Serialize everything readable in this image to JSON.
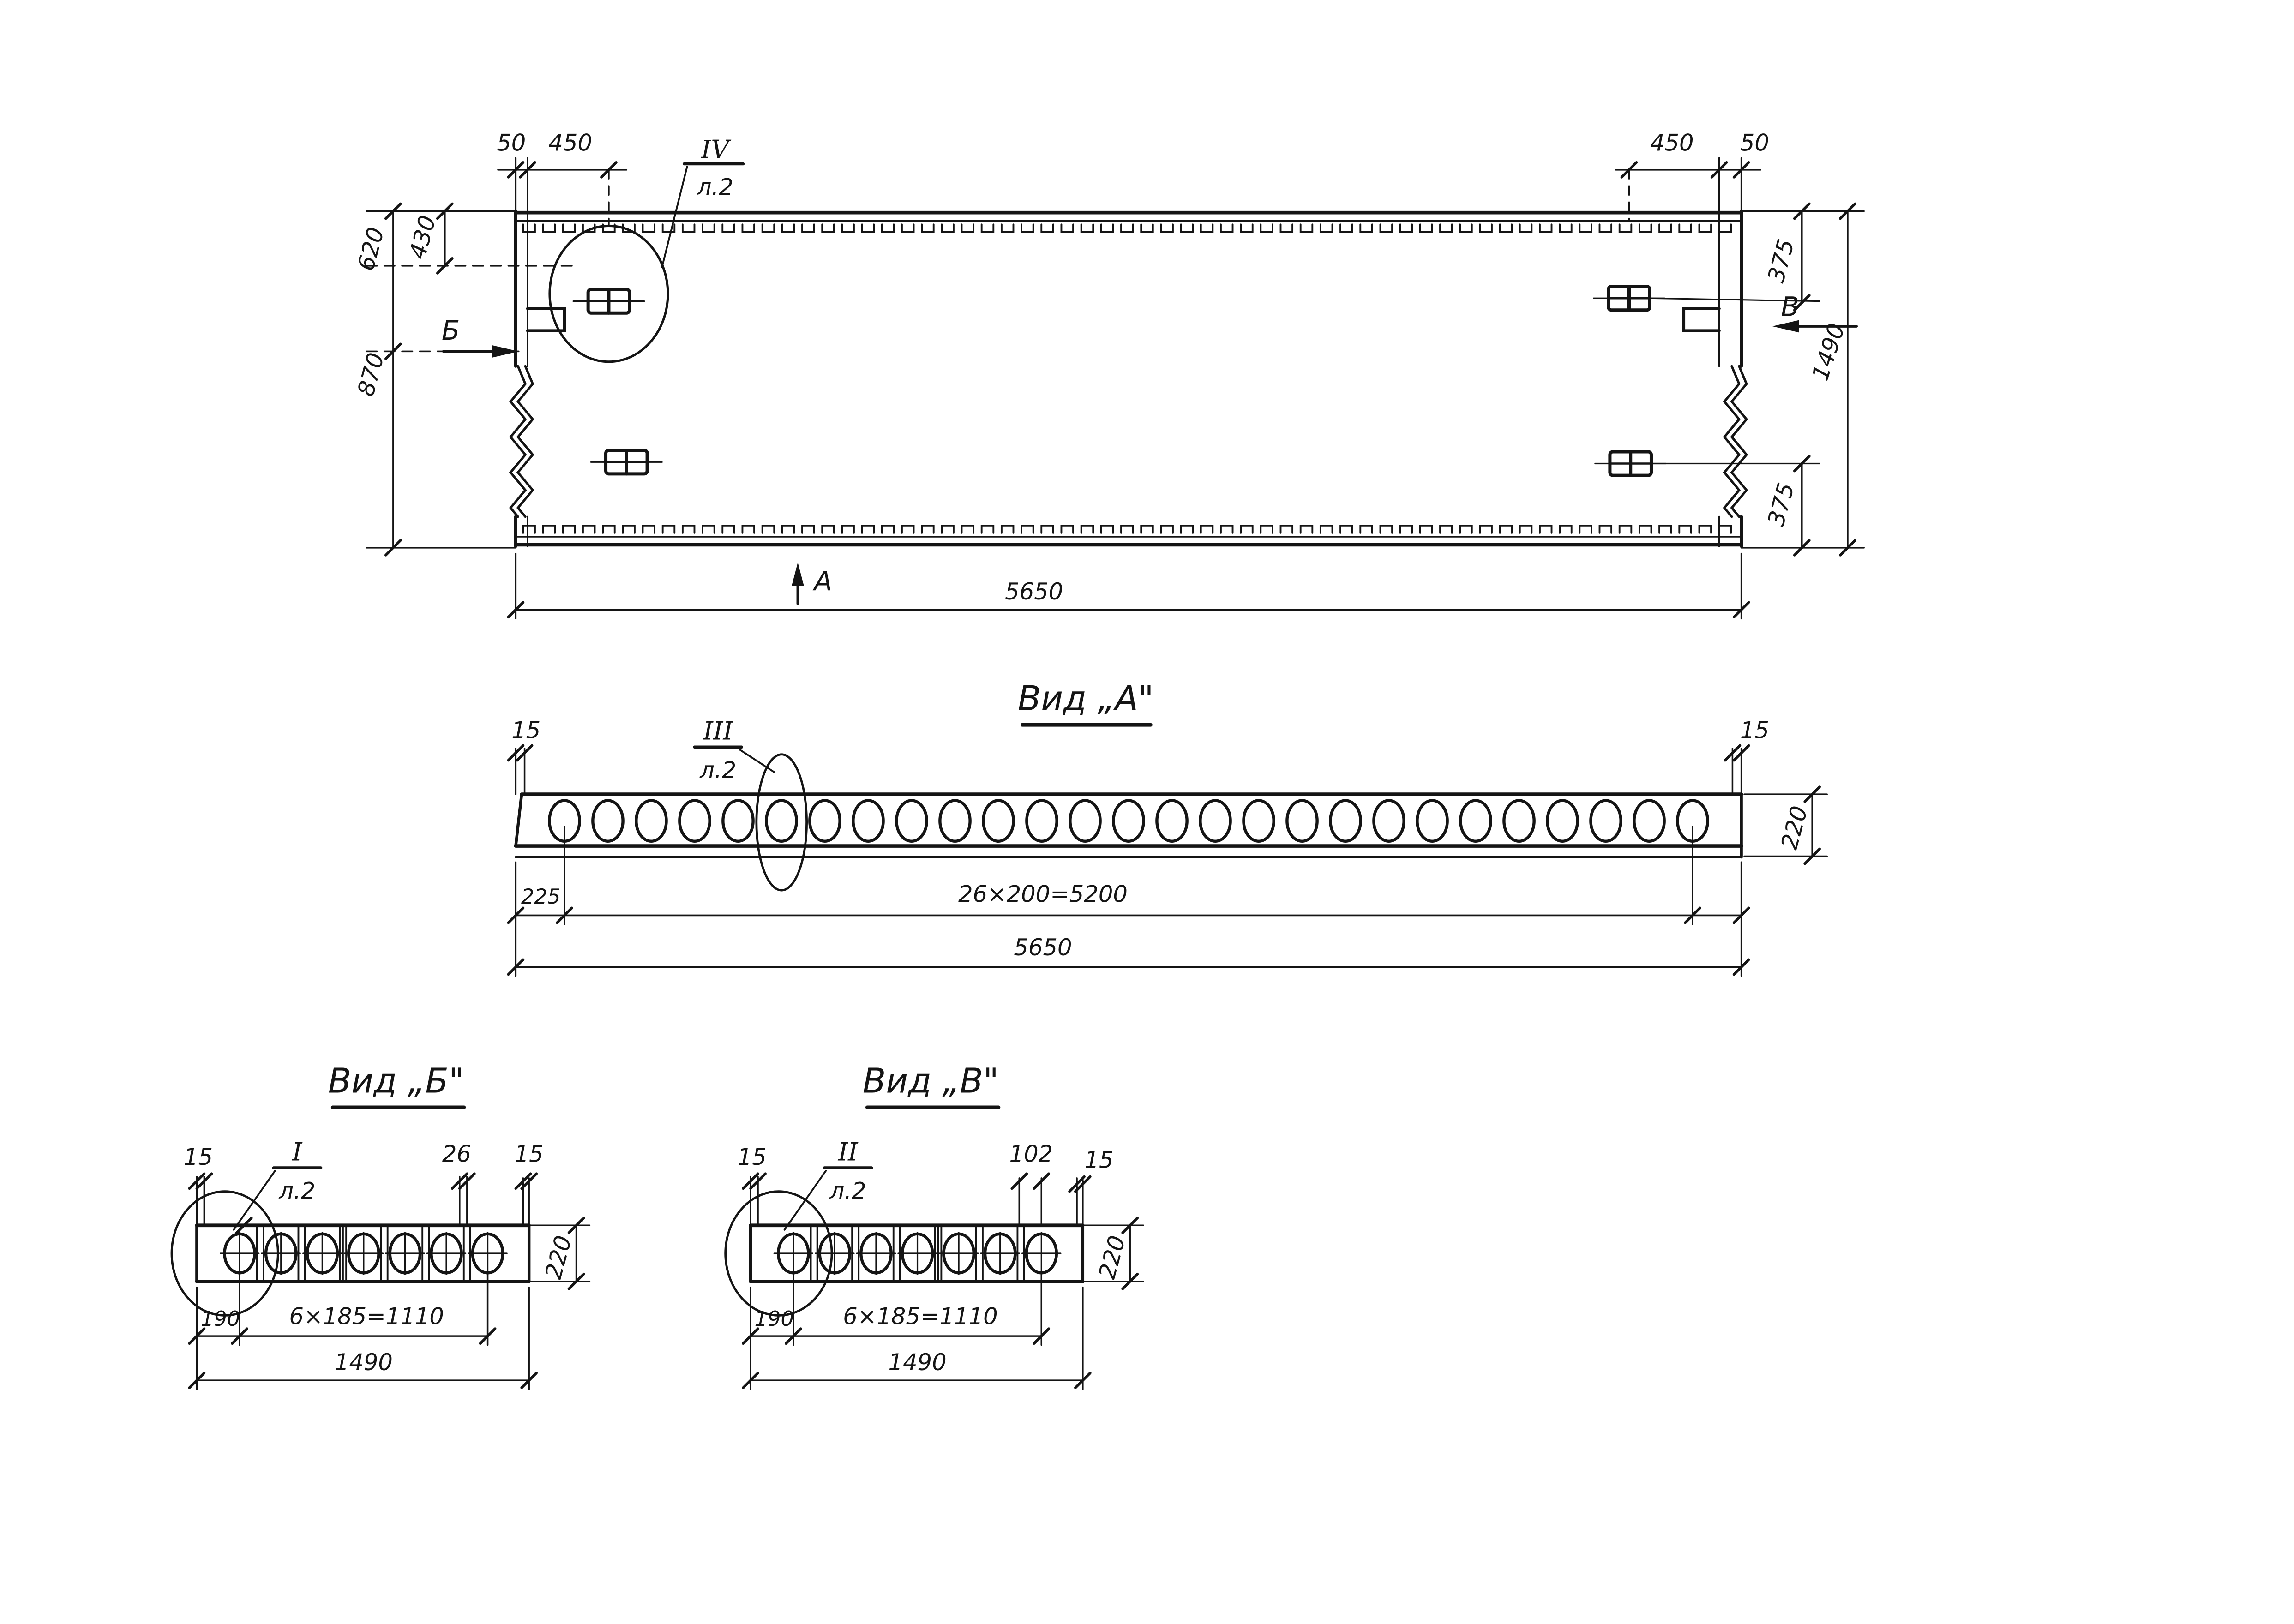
{
  "colors": {
    "paper": "#ffffff",
    "ink": "#141414"
  },
  "plan": {
    "dims": {
      "d50_left": "50",
      "d450_left": "450",
      "d450_right": "450",
      "d50_right": "50",
      "d620": "620",
      "d430": "430",
      "d870": "870",
      "d375_top": "375",
      "d1490": "1490",
      "d375_bottom": "375",
      "d5650": "5650"
    },
    "callout": {
      "detail": "IV",
      "sheet": "л.2"
    },
    "arrows": {
      "a": "А",
      "b": "Б",
      "v": "В"
    }
  },
  "view_a": {
    "title": "Вид „А\"",
    "holes": 27,
    "callout": {
      "detail": "III",
      "sheet": "л.2"
    },
    "dims": {
      "d15_left": "15",
      "d15_right": "15",
      "d220": "220",
      "d225": "225",
      "d26x200": "26×200=5200",
      "d5650": "5650"
    }
  },
  "view_b": {
    "title": "Вид „Б\"",
    "holes": 7,
    "callout": {
      "detail": "I",
      "sheet": "л.2"
    },
    "dims": {
      "d15_left": "15",
      "d26": "26",
      "d15_right": "15",
      "d220": "220",
      "d190": "190",
      "d6x185": "6×185=1110",
      "d1490": "1490"
    }
  },
  "view_v": {
    "title": "Вид „В\"",
    "holes": 7,
    "callout": {
      "detail": "II",
      "sheet": "л.2"
    },
    "dims": {
      "d15_left": "15",
      "d102": "102",
      "d15_right": "15",
      "d220": "220",
      "d190": "190",
      "d6x185": "6×185=1110",
      "d1490": "1490"
    }
  }
}
